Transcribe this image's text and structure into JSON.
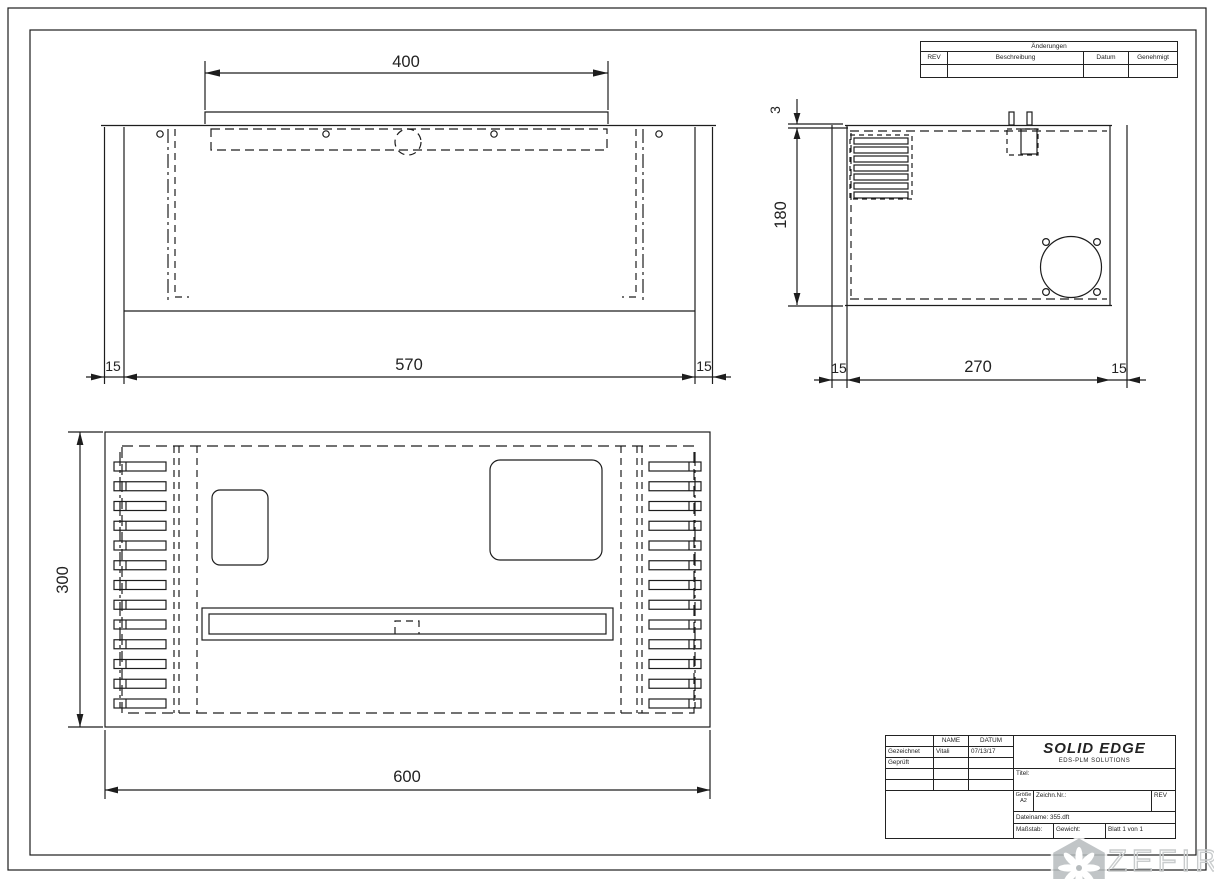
{
  "changes_table": {
    "title": "Änderungen",
    "col_rev": "REV",
    "col_beschreibung": "Beschreibung",
    "col_datum": "Datum",
    "col_genehmigt": "Genehmigt"
  },
  "title_block": {
    "name_header": "NAME",
    "datum_header": "DATUM",
    "gezeichnet_label": "Gezeichnet",
    "gezeichnet_name": "Vitali",
    "gezeichnet_datum": "07/13/17",
    "geprueft_label": "Geprüft",
    "logo_title": "SOLID EDGE",
    "logo_subtitle": "EDS-PLM SOLUTIONS",
    "titel_label": "Titel:",
    "groesse_label": "Größe",
    "groesse_value": "A2",
    "zeichnr_label": "Zeichn.Nr.:",
    "rev_label": "REV",
    "dateiname_label": "Dateiname: 355.dft",
    "massstab_label": "Maßstab:",
    "gewicht_label": "Gewicht:",
    "blatt_label": "Blatt 1 von 1"
  },
  "dims": {
    "front_top": "400",
    "front_bottom_left": "15",
    "front_bottom_mid": "570",
    "front_bottom_right": "15",
    "side_thickness": "3",
    "side_height": "180",
    "side_bottom_left": "15",
    "side_bottom_mid": "270",
    "side_bottom_right": "15",
    "plan_left": "300",
    "plan_bottom": "600"
  },
  "plan_view": {
    "vent_slots_per_side": 13
  },
  "side_view": {
    "louver_count": 7
  },
  "watermark": {
    "text": "ZEFIRE",
    "icon": "pinwheel-icon"
  }
}
